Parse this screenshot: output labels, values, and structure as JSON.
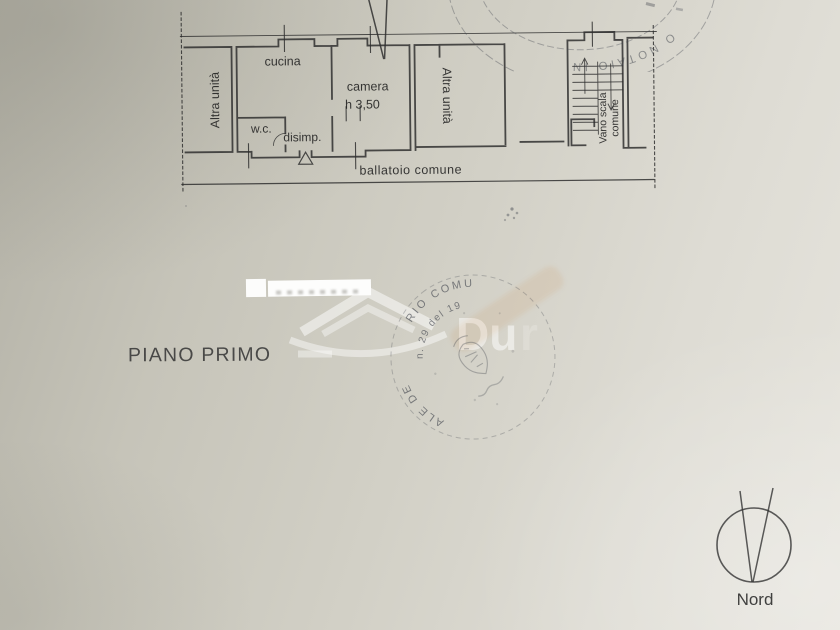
{
  "document": {
    "floor_label": "PIANO PRIMO"
  },
  "plan": {
    "rooms": {
      "altra_unita_left": "Altra unità",
      "cucina": "cucina",
      "camera": "camera",
      "camera_height": "h 3,50",
      "wc": "w.c.",
      "disimpegno": "disimp.",
      "altra_unita_right": "Altra unità",
      "vano_scala_line1": "Vano scala",
      "vano_scala_line2": "comune",
      "ballatoio": "ballatoio comune"
    }
  },
  "compass": {
    "label": "Nord"
  },
  "watermark": {
    "text": "Du",
    "text_faint": "r"
  },
  "stamps": {
    "main_outer_a": "ALE DE",
    "main_outer_b": "RIO COMU",
    "main_inner_ring": "n. 29 del 19",
    "top_arc": "O NOTAIO IN"
  },
  "colors": {
    "paper_light": "#e6e4dd",
    "paper_dark": "#b2b0a5",
    "ink": "#2d2d2d",
    "stamp_ink": "#3f434c"
  }
}
